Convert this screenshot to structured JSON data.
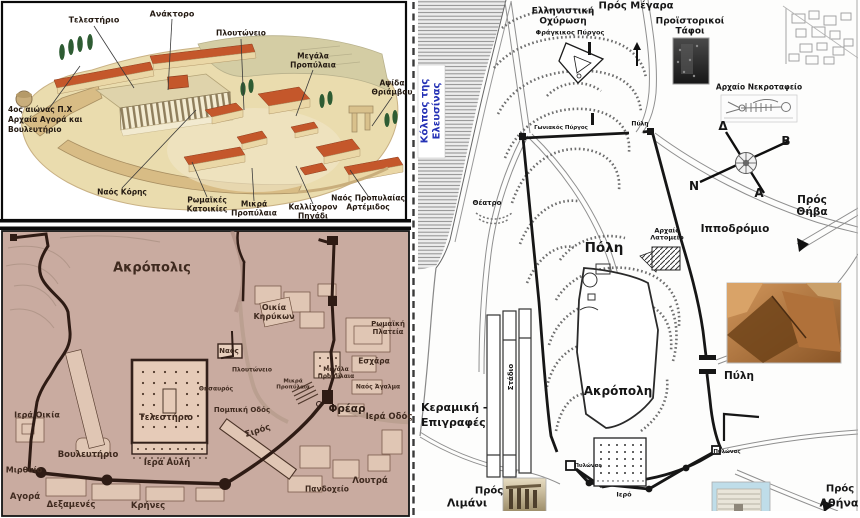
{
  "figure": {
    "description_labels_language": "Greek",
    "colors": {
      "gulf_text_blue": "#2431b5",
      "siteplan_background_tan": "#c9aba0",
      "siteplan_wall_dark": "#2e1b14",
      "reconstruction_terrain": "#eadcae",
      "reconstruction_roof_red": "#c4572b",
      "citymap_ink": "#161616"
    }
  },
  "reconstruction": {
    "labels": {
      "telesterion": "Τελεστήριο",
      "anaktoro": "Ανάκτορο",
      "ploutoneio": "Πλουτώνειο",
      "megala_propylaia": "Μεγάλα\nΠροπύλαια",
      "apsida_thriamvou": "Αψίδα\nΘριάμβου",
      "agora_note": "4ος αιώνας Π.Χ\nΑρχαία Αγορά και\nΒουλευτήριο",
      "naos_koris": "Ναός Κόρης",
      "romaikes_katoikies": "Ρωμαϊκές\nΚατοικίες",
      "mikra_propylaia": "Μικρά\nΠροπύλαια",
      "kallichoron_pigadi": "Καλλίχορον\nΠηγάδι",
      "naos_propylaias_artemidos": "Ναός Προπυλαίας\nΑρτέμιδος"
    }
  },
  "siteplan": {
    "labels": {
      "akropolis": "Ακρόπολις",
      "oikia_kirykon": "Οικία\nΚηρύκων",
      "romaiki_plateia": "Ρωμαϊκή\nΠλατεία",
      "naos": "Ναός",
      "ploutoneio": "Πλουτώνειο",
      "megala_propylaia": "Μεγάλα\nΠροπύλαια",
      "eschara": "Εσχάρα",
      "naos_agalma": "Ναός Άγαλμα",
      "thisavros": "Θησαυρός",
      "mikra_propylaia": "Μικρά\nΠροπύλαια",
      "pompiki_odos": "Πομπική Οδός",
      "frear": "Φρέαρ",
      "iera_odos": "Ιερά Οδός",
      "telesterion": "Τελεστήριο",
      "siros": "Σιρός",
      "iera_oikia": "Ιερά Οικία",
      "vouleuterio": "Βουλευτήριο",
      "iera_avli": "Ιερά Αυλή",
      "mirthaio": "Μιρθαίο",
      "agora": "Αγορά",
      "dexamenes": "Δεξαμενές",
      "krines": "Κρήνες",
      "loutra": "Λουτρά",
      "pandocheio": "Πανδοχείο"
    }
  },
  "citymap": {
    "gulf": "Κόλπος της\nΕλευσίνας",
    "labels": {
      "pros_megara": "Πρός Μέγαρα",
      "ellinistiki_ochyrosi": "Ελληνιστική\nΟχύρωση",
      "fragkikos_pyrgos": "Φράγκικος Πύργος",
      "proistorikoi_tafoi": "Προϊστορικοί\nΤάφοι",
      "archaio_nekrotafeio": "Αρχαίο Νεκροταφείο",
      "goniakos_pyrgos": "Γωνιακός Πύργος",
      "pyli_north": "Πύλη",
      "theatro": "Θέατρο",
      "poli": "Πόλη",
      "archaio_latomeio": "Αρχαίο\nΛατομείο",
      "ippodromio": "Ιπποδρόμιο",
      "pros_thiva": "Πρός Θήβα",
      "stadio": "Στάδιο",
      "keramiki_epigrafes": "Κεραμική -\nΕπιγραφές",
      "akropoli": "Ακρόπολη",
      "pyli_east": "Πύλη",
      "pylonas_west": "Πυλώνας",
      "pylonas_east": "Πυλώνας",
      "iero": "Ιερό",
      "pros_limani_1": "Πρός",
      "pros_limani_2": "Λιμάνι",
      "pros_athina_1": "Πρός",
      "pros_athina_2": "Αθήνα"
    },
    "compass": {
      "top_left": "Δ",
      "right": "Β",
      "bottom_left": "Ν",
      "bottom_right": "Α"
    }
  }
}
